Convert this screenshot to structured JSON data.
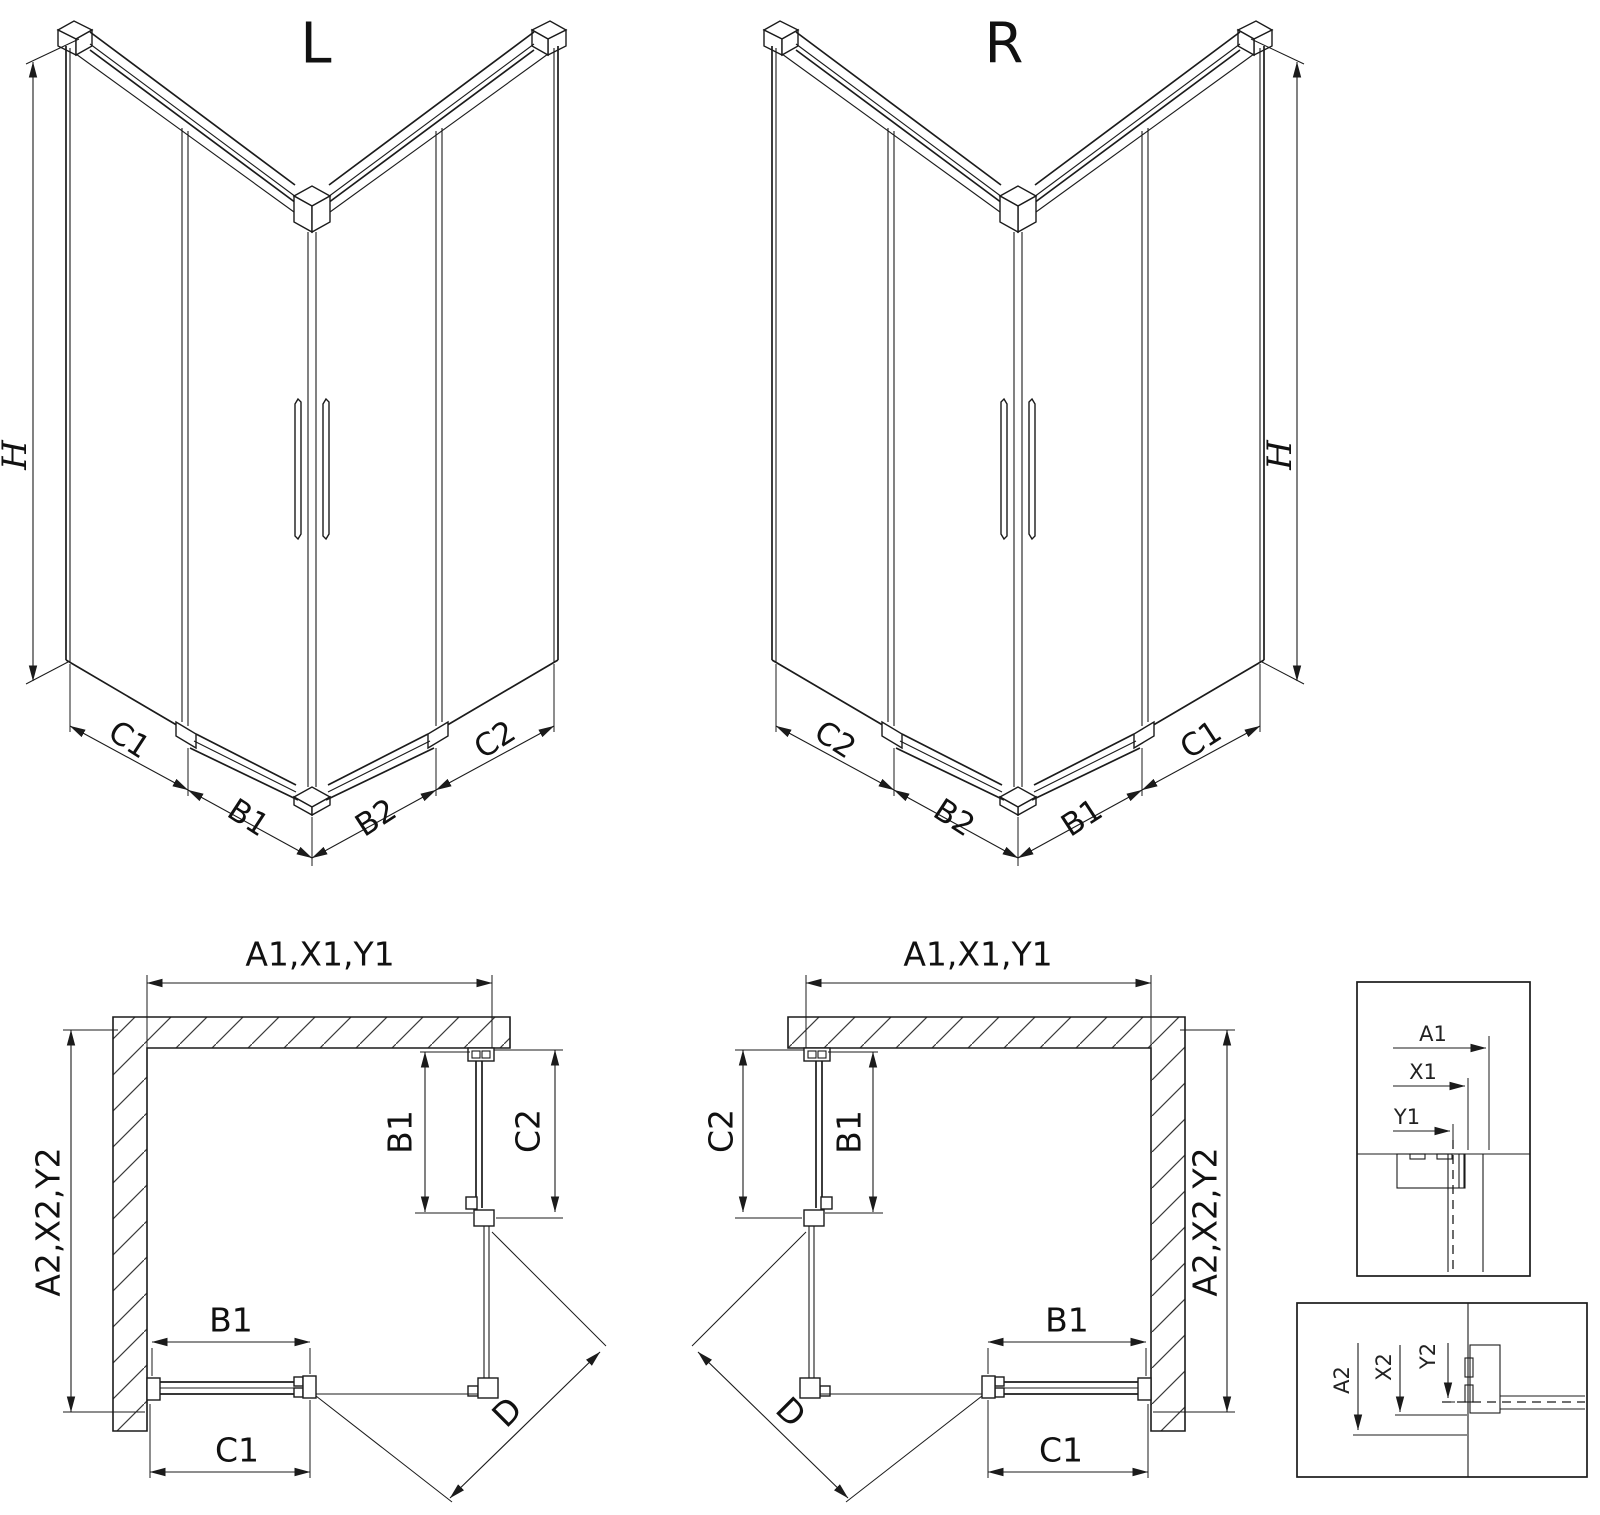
{
  "page": {
    "background": "#ffffff",
    "line_color": "#1b1b1b",
    "text_color": "#111111",
    "drawing_type": "shower enclosure technical dimension drawing"
  },
  "iso_left": {
    "title": "L",
    "height_label": "H",
    "bottom_labels": {
      "c1": "C1",
      "b1": "B1",
      "b2": "B2",
      "c2": "C2"
    }
  },
  "iso_right": {
    "title": "R",
    "height_label": "H",
    "bottom_labels": {
      "c2": "C2",
      "b2": "B2",
      "b1": "B1",
      "c1": "C1"
    }
  },
  "plan_left": {
    "width_label": "A1,X1,Y1",
    "depth_label": "A2,X2,Y2",
    "door_side_label": "B1",
    "fixed_side_label": "C2",
    "door_bottom_label": "B1",
    "fixed_bottom_label": "C1",
    "diagonal_label": "D"
  },
  "plan_right": {
    "width_label": "A1,X1,Y1",
    "depth_label": "A2,X2,Y2",
    "door_side_label": "B1",
    "fixed_side_label": "C2",
    "door_bottom_label": "B1",
    "fixed_bottom_label": "C1",
    "diagonal_label": "D"
  },
  "detail_widths": {
    "a1": "A1",
    "x1": "X1",
    "y1": "Y1"
  },
  "detail_depths": {
    "a2": "A2",
    "x2": "X2",
    "y2": "Y2"
  }
}
